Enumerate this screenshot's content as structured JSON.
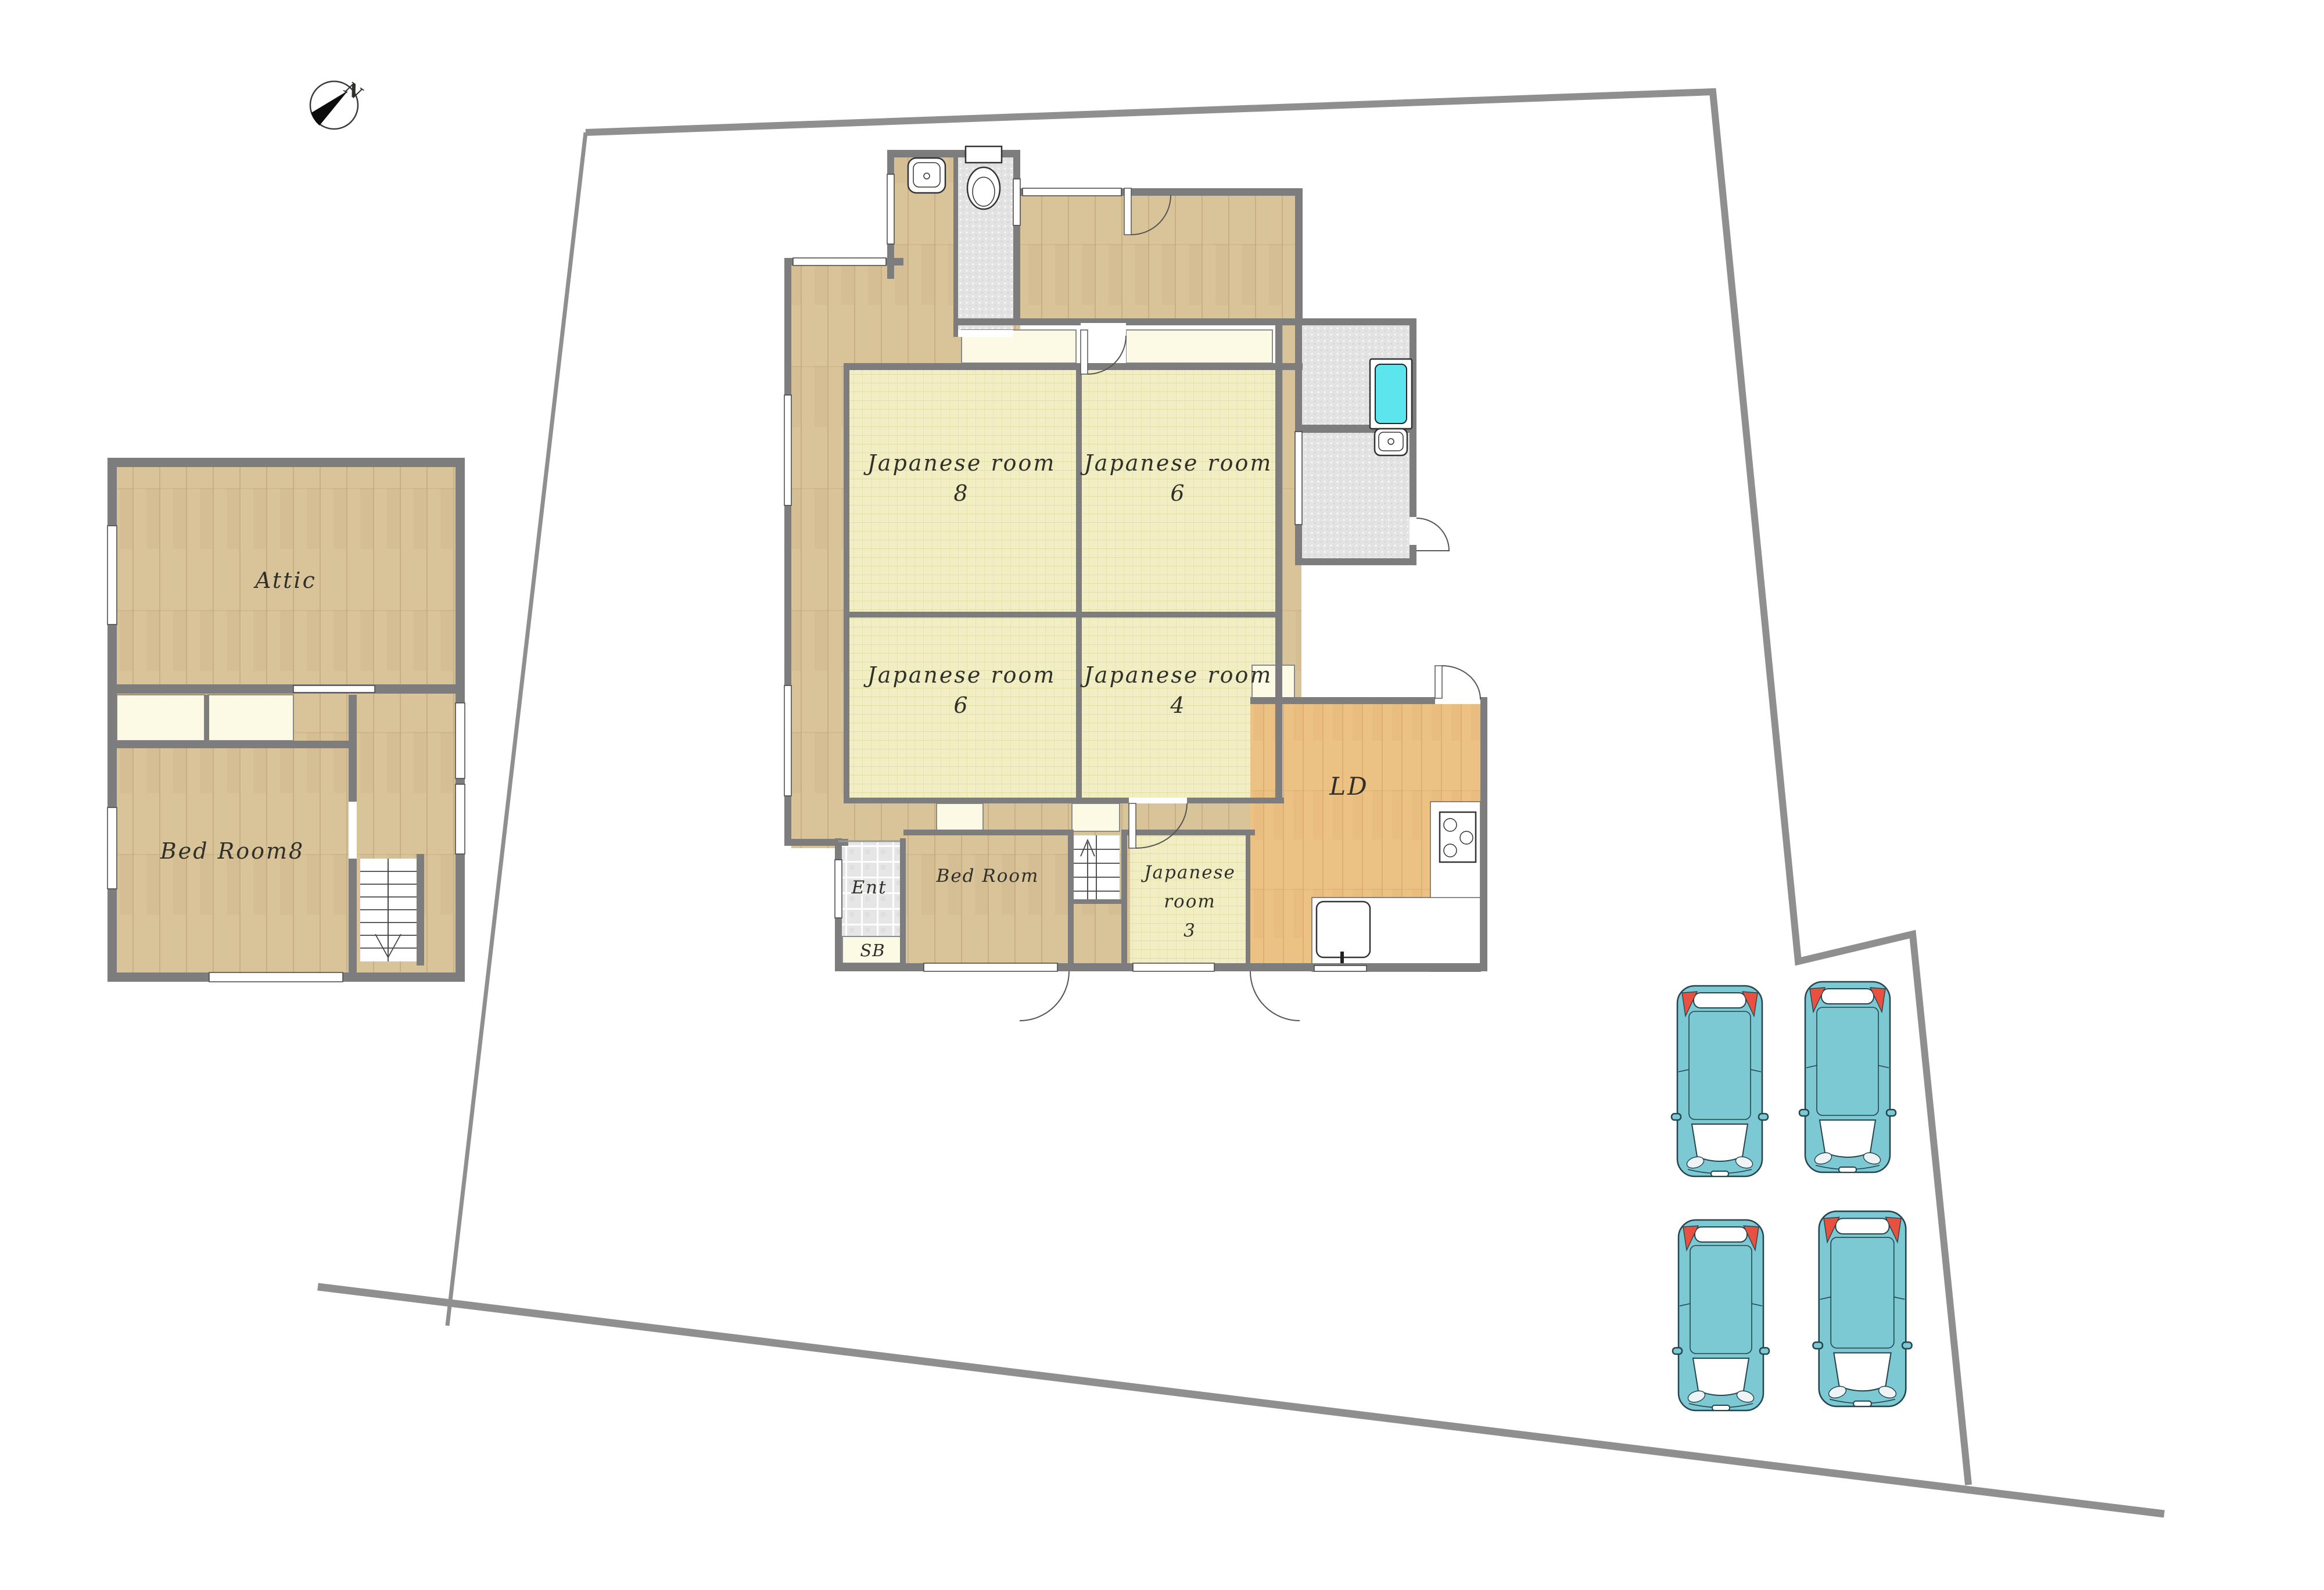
{
  "compass": {
    "north_label": "N"
  },
  "second_floor": {
    "attic": "Attic",
    "bed_room_8": "Bed Room8"
  },
  "first_floor": {
    "japanese_room_8": {
      "line1": "Japanese room",
      "line2": "8"
    },
    "japanese_room_6_upper": {
      "line1": "Japanese room",
      "line2": "6"
    },
    "japanese_room_6_lower": {
      "line1": "Japanese room",
      "line2": "6"
    },
    "japanese_room_4": {
      "line1": "Japanese room",
      "line2": "4"
    },
    "japanese_room_3": {
      "line1": "Japanese",
      "line2": "room",
      "line3": "3"
    },
    "living_dining": "LD",
    "entrance": "Ent",
    "shoe_box": "SB",
    "bed_room": "Bed Room"
  },
  "colors": {
    "wall": "#7d7d7d",
    "boundary": "#8f8f8f",
    "wood": "#d9c49a",
    "wood_line": "#b4986a",
    "ld_wood": "#ecc184",
    "ld_wood_line": "#cf9e5c",
    "tatami": "#f0eec2",
    "tatami_line": "#d6d192",
    "cream": "#fcf9e4",
    "tile": "#e6e6e6",
    "wet": "#e3e3e3",
    "tub": "#5ce5ec",
    "car_body": "#7cc8d3",
    "car_outline": "#24454e",
    "car_taillight": "#e8503f",
    "label": "#30302a"
  }
}
